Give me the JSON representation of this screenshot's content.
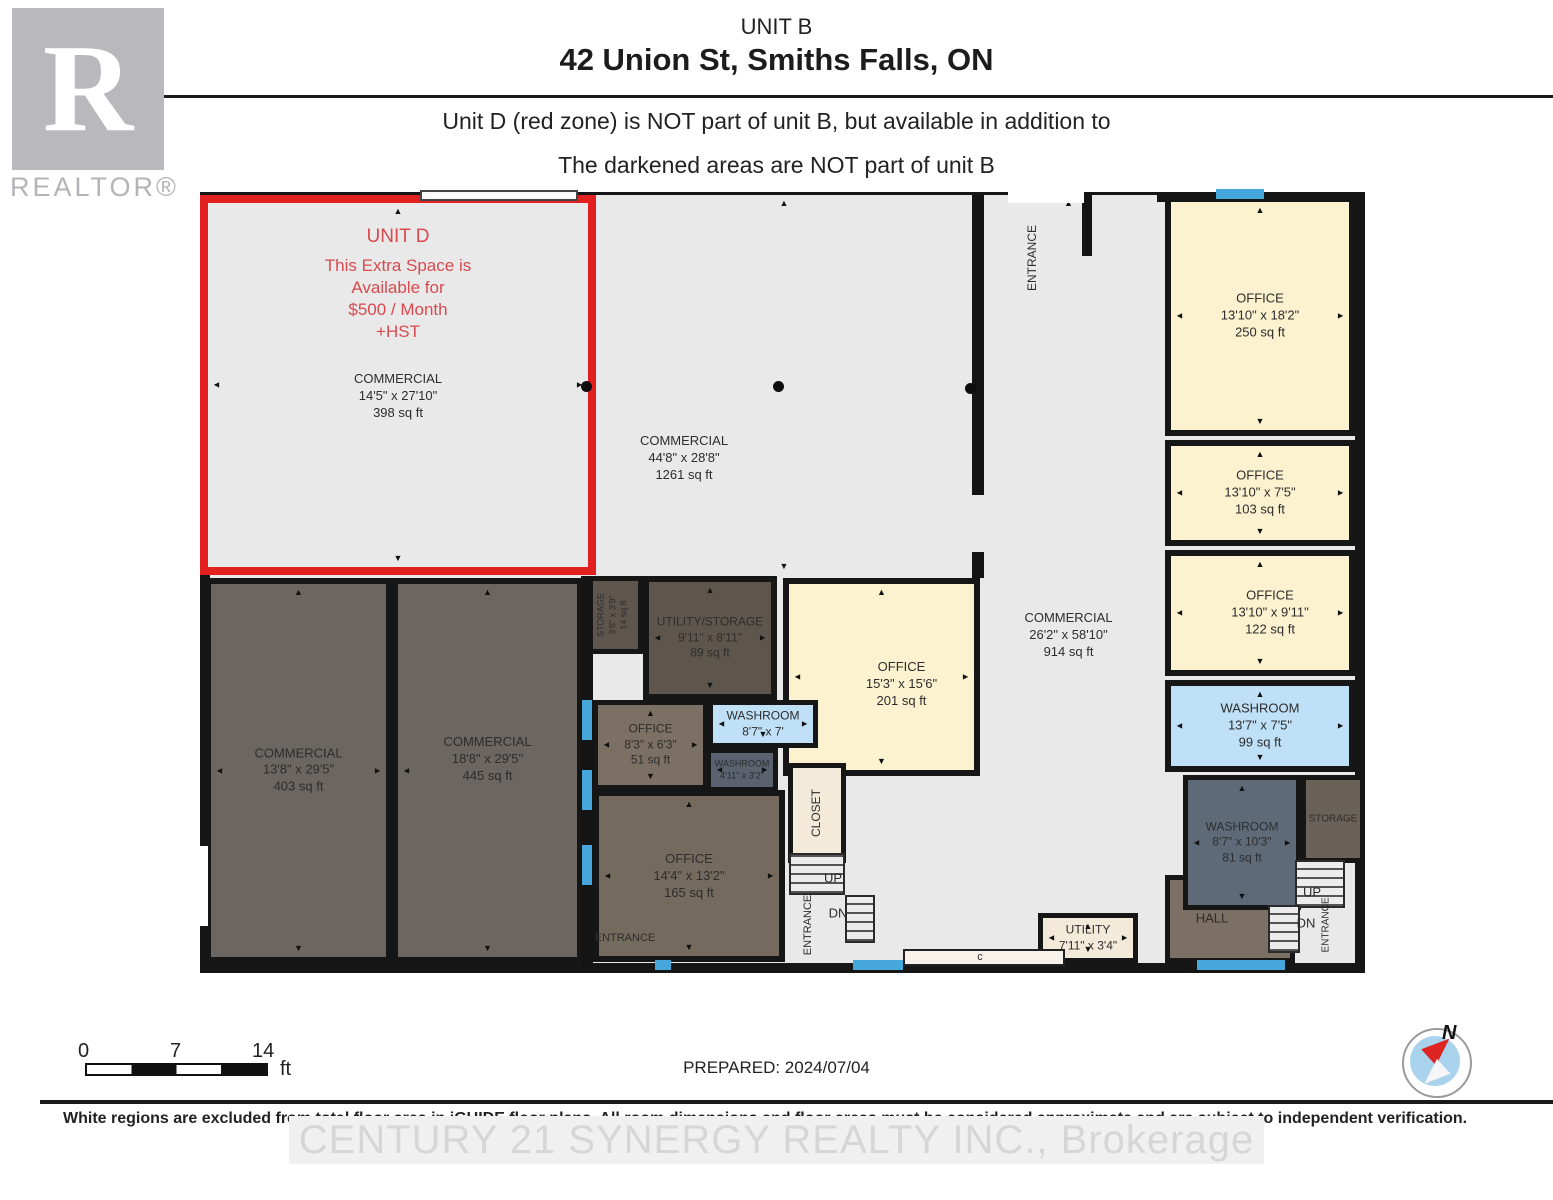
{
  "header": {
    "unit_label": "UNIT B",
    "address": "42 Union St, Smiths Falls, ON",
    "note1": "Unit D (red zone) is NOT part of unit B, but available in addition to",
    "note2": "The darkened areas are NOT part of unit B"
  },
  "logo": {
    "letter": "R",
    "word": "REALTOR®"
  },
  "colors": {
    "unit_d_border": "#e2201f",
    "unit_d_text": "#d84a4e",
    "floor_light": "#e9e9e9",
    "cream": "#fcf2d0",
    "cream_light": "#f3ead9",
    "washroom_blue": "#bfe0f6",
    "window_blue": "#46a7dd",
    "dark_commercial": "#6b6661",
    "dark_utility": "#5e564d",
    "brown_office": "#756a5e",
    "slate_washroom": "#5e6a77",
    "wall": "#141414"
  },
  "floorplan": {
    "rooms": [
      {
        "id": "corridor",
        "x": 980,
        "y": 195,
        "w": 177,
        "h": 768,
        "fill": "#e9e9e9",
        "border": "none",
        "labels": [
          {
            "lines": [
              "COMMERCIAL",
              "26'2\" x 58'10\"",
              "914 sq ft"
            ],
            "size": 13,
            "dy": 415
          }
        ],
        "arrows": [
          "up",
          "down"
        ]
      },
      {
        "id": "commercial-1261",
        "x": 596,
        "y": 195,
        "w": 376,
        "h": 380,
        "fill": "#e9e9e9",
        "border": "none",
        "labels": [
          {
            "lines": [
              "COMMERCIAL",
              "44'8\" x 28'8\"",
              "1261 sq ft"
            ],
            "size": 13,
            "dy": 238,
            "dx": -100
          }
        ],
        "arrows": [
          "up",
          "down"
        ]
      },
      {
        "id": "unit-d",
        "x": 200,
        "y": 195,
        "w": 396,
        "h": 380,
        "fill": "#e9e9e9",
        "border": "8px solid #e2201f",
        "labels": [
          {
            "lines": [
              "UNIT D"
            ],
            "size": 19,
            "dy": 22,
            "color": "#d84a4e"
          },
          {
            "lines": [
              "This Extra Space is",
              "Available for",
              "$500 / Month",
              "+HST"
            ],
            "size": 17,
            "dy": 52,
            "color": "#d84a4e"
          },
          {
            "lines": [
              "COMMERCIAL",
              "14'5\" x 27'10\"",
              "398 sq ft"
            ],
            "size": 13,
            "dy": 168
          }
        ],
        "arrows": [
          "up",
          "down",
          "left",
          "right"
        ]
      },
      {
        "id": "commercial-403",
        "x": 205,
        "y": 578,
        "w": 187,
        "h": 385,
        "fill": "#6b6661",
        "border": "6px solid #161616",
        "labels": [
          {
            "lines": [
              "COMMERCIAL",
              "13'8\" x 29'5\"",
              "403 sq ft"
            ],
            "size": 13
          }
        ],
        "arrows": [
          "up",
          "down",
          "left",
          "right"
        ]
      },
      {
        "id": "commercial-445",
        "x": 392,
        "y": 578,
        "w": 191,
        "h": 385,
        "fill": "#6b6661",
        "border": "6px solid #161616",
        "labels": [
          {
            "lines": [
              "COMMERCIAL",
              "18'8\" x 29'5\"",
              "445 sq ft"
            ],
            "size": 13,
            "dy": 150
          }
        ],
        "arrows": [
          "up",
          "down",
          "left"
        ]
      },
      {
        "id": "office-201",
        "x": 783,
        "y": 578,
        "w": 197,
        "h": 198,
        "fill": "#fcf2d0",
        "border": "6px solid #161616",
        "labels": [
          {
            "lines": [
              "OFFICE",
              "15'3\" x 15'6\"",
              "201 sq ft"
            ],
            "size": 13,
            "dy": 75,
            "dx": 20
          }
        ],
        "arrows": [
          "up",
          "left",
          "right",
          "down"
        ]
      },
      {
        "id": "utility-storage-89",
        "x": 643,
        "y": 576,
        "w": 134,
        "h": 124,
        "fill": "#5e564d",
        "border": "6px solid #161616",
        "labels": [
          {
            "lines": [
              "UTILITY/STORAGE",
              "9'11\" x 8'11\"",
              "89 sq ft"
            ],
            "size": 12
          }
        ],
        "arrows": [
          "up",
          "down",
          "left",
          "right"
        ]
      },
      {
        "id": "storage-14",
        "x": 583,
        "y": 576,
        "w": 60,
        "h": 78,
        "fill": "#5e564d",
        "border": "5px solid #161616",
        "labels": [
          {
            "lines": [
              "STORAGE",
              "3'8\" x 3'9\"",
              "14 sq ft"
            ],
            "size": 9,
            "vertical": true
          }
        ]
      },
      {
        "id": "office-51",
        "x": 593,
        "y": 700,
        "w": 115,
        "h": 90,
        "fill": "#7b7063",
        "border": "5px solid #161616",
        "labels": [
          {
            "lines": [
              "OFFICE",
              "8'3\" x 6'3\"",
              "51 sq ft"
            ],
            "size": 12
          }
        ],
        "arrows": [
          "up",
          "down",
          "left",
          "right"
        ]
      },
      {
        "id": "washroom-8-7",
        "x": 708,
        "y": 700,
        "w": 110,
        "h": 48,
        "fill": "#bfe0f6",
        "border": "5px solid #161616",
        "labels": [
          {
            "lines": [
              "WASHROOM",
              "8'7\" x 7'"
            ],
            "size": 12
          }
        ],
        "arrows": [
          "left",
          "right",
          "down"
        ]
      },
      {
        "id": "washroom-4-11",
        "x": 706,
        "y": 748,
        "w": 72,
        "h": 44,
        "fill": "#59626e",
        "border": "5px solid #161616",
        "labels": [
          {
            "lines": [
              "WASHROOM",
              "4'11\" x 3'2\""
            ],
            "size": 9
          }
        ],
        "arrows": [
          "left",
          "right"
        ]
      },
      {
        "id": "office-165",
        "x": 593,
        "y": 790,
        "w": 192,
        "h": 172,
        "fill": "#746a5e",
        "border": "6px solid #161616",
        "labels": [
          {
            "lines": [
              "OFFICE",
              "14'4\" x 13'2\"",
              "165 sq ft"
            ],
            "size": 13,
            "dy": 55
          }
        ],
        "arrows": [
          "up",
          "down",
          "left",
          "right"
        ]
      },
      {
        "id": "closet",
        "x": 788,
        "y": 763,
        "w": 58,
        "h": 100,
        "fill": "#f3ead9",
        "border": "5px solid #161616",
        "labels": [
          {
            "lines": [
              "CLOSET"
            ],
            "size": 12,
            "vertical": true
          }
        ]
      },
      {
        "id": "office-250",
        "x": 1165,
        "y": 196,
        "w": 190,
        "h": 240,
        "fill": "#fcf2d0",
        "border": "6px solid #161616",
        "labels": [
          {
            "lines": [
              "OFFICE",
              "13'10\" x 18'2\"",
              "250 sq ft"
            ],
            "size": 13
          }
        ],
        "arrows": [
          "up",
          "down",
          "left",
          "right"
        ]
      },
      {
        "id": "office-103",
        "x": 1165,
        "y": 440,
        "w": 190,
        "h": 106,
        "fill": "#fcf2d0",
        "border": "6px solid #161616",
        "labels": [
          {
            "lines": [
              "OFFICE",
              "13'10\" x 7'5\"",
              "103 sq ft"
            ],
            "size": 13
          }
        ],
        "arrows": [
          "up",
          "down",
          "left",
          "right"
        ]
      },
      {
        "id": "office-122",
        "x": 1165,
        "y": 550,
        "w": 190,
        "h": 126,
        "fill": "#fcf2d0",
        "border": "6px solid #161616",
        "labels": [
          {
            "lines": [
              "OFFICE",
              "13'10\" x 9'11\"",
              "122 sq ft"
            ],
            "size": 13,
            "dx": 10
          }
        ],
        "arrows": [
          "up",
          "down",
          "left",
          "right"
        ]
      },
      {
        "id": "washroom-99",
        "x": 1165,
        "y": 680,
        "w": 190,
        "h": 92,
        "fill": "#bfe0f6",
        "border": "6px solid #161616",
        "labels": [
          {
            "lines": [
              "WASHROOM",
              "13'7\" x 7'5\"",
              "99 sq ft"
            ],
            "size": 13
          }
        ],
        "arrows": [
          "up",
          "down",
          "left",
          "right"
        ]
      },
      {
        "id": "hall",
        "x": 1165,
        "y": 875,
        "w": 130,
        "h": 88,
        "fill": "#7c7064",
        "border": "5px solid #161616",
        "labels": [
          {
            "lines": [
              "HALL"
            ],
            "size": 13,
            "dx": -18
          }
        ]
      },
      {
        "id": "washroom-81",
        "x": 1183,
        "y": 775,
        "w": 118,
        "h": 135,
        "fill": "#5e6a77",
        "border": "5px solid #161616",
        "labels": [
          {
            "lines": [
              "WASHROOM",
              "8'7\" x 10'3\"",
              "81 sq ft"
            ],
            "size": 12
          }
        ],
        "arrows": [
          "up",
          "down",
          "left",
          "right"
        ]
      },
      {
        "id": "storage-br",
        "x": 1301,
        "y": 775,
        "w": 64,
        "h": 88,
        "fill": "#6a6158",
        "border": "5px solid #161616",
        "labels": [
          {
            "lines": [
              "STORAGE"
            ],
            "size": 10
          }
        ]
      },
      {
        "id": "utility",
        "x": 1038,
        "y": 913,
        "w": 100,
        "h": 50,
        "fill": "#f3ead9",
        "border": "5px solid #161616",
        "labels": [
          {
            "lines": [
              "UTILITY",
              "7'11\" x 3'4\""
            ],
            "size": 12
          }
        ],
        "arrows": [
          "up",
          "down",
          "left",
          "right"
        ]
      }
    ],
    "features": [
      {
        "type": "rect",
        "name": "wall",
        "x": 972,
        "y": 195,
        "w": 12,
        "h": 300,
        "fill": "#141414"
      },
      {
        "type": "rect",
        "name": "wall",
        "x": 972,
        "y": 552,
        "w": 12,
        "h": 26,
        "fill": "#141414"
      },
      {
        "type": "rect",
        "name": "wall",
        "x": 581,
        "y": 576,
        "w": 12,
        "h": 392,
        "fill": "#141414"
      },
      {
        "type": "rect",
        "name": "wall",
        "x": 1082,
        "y": 192,
        "w": 10,
        "h": 64,
        "fill": "#141414"
      },
      {
        "type": "rect",
        "name": "storefront-window",
        "x": 420,
        "y": 190,
        "w": 158,
        "h": 11,
        "fill": "#fafafa",
        "border": "2px solid #444"
      },
      {
        "type": "rect",
        "name": "entrance-opening",
        "x": 1008,
        "y": 191,
        "w": 76,
        "h": 12,
        "fill": "#ffffff"
      },
      {
        "type": "rect",
        "name": "door-opening",
        "x": 196,
        "y": 846,
        "w": 12,
        "h": 80,
        "fill": "#ffffff"
      },
      {
        "type": "rect",
        "name": "door-recess",
        "x": 903,
        "y": 949,
        "w": 162,
        "h": 17,
        "fill": "#f7f3ea",
        "border": "2px solid #222"
      },
      {
        "type": "rect",
        "name": "window",
        "x": 1216,
        "y": 189,
        "w": 48,
        "h": 10,
        "fill": "#46a7dd"
      },
      {
        "type": "rect",
        "name": "window",
        "x": 853,
        "y": 960,
        "w": 50,
        "h": 10,
        "fill": "#46a7dd"
      },
      {
        "type": "rect",
        "name": "window",
        "x": 1197,
        "y": 960,
        "w": 88,
        "h": 10,
        "fill": "#46a7dd"
      },
      {
        "type": "rect",
        "name": "window",
        "x": 655,
        "y": 960,
        "w": 16,
        "h": 10,
        "fill": "#46a7dd"
      },
      {
        "type": "rect",
        "name": "window",
        "x": 582,
        "y": 700,
        "w": 10,
        "h": 40,
        "fill": "#46a7dd"
      },
      {
        "type": "rect",
        "name": "window",
        "x": 582,
        "y": 770,
        "w": 10,
        "h": 40,
        "fill": "#46a7dd"
      },
      {
        "type": "rect",
        "name": "window",
        "x": 582,
        "y": 845,
        "w": 10,
        "h": 40,
        "fill": "#46a7dd"
      },
      {
        "type": "stairs",
        "name": "stairs-up-mid",
        "x": 789,
        "y": 853,
        "w": 56,
        "h": 42
      },
      {
        "type": "stairs",
        "name": "stairs-dn-mid",
        "x": 845,
        "y": 895,
        "w": 30,
        "h": 48
      },
      {
        "type": "stairs",
        "name": "stairs-up-right",
        "x": 1295,
        "y": 860,
        "w": 50,
        "h": 48
      },
      {
        "type": "stairs",
        "name": "stairs-dn-right",
        "x": 1268,
        "y": 905,
        "w": 32,
        "h": 48
      },
      {
        "type": "dot",
        "name": "column",
        "x": 586,
        "y": 386
      },
      {
        "type": "dot",
        "name": "column",
        "x": 778,
        "y": 386
      },
      {
        "type": "dot",
        "name": "column",
        "x": 970,
        "y": 388
      }
    ],
    "labels": [
      {
        "text": "ENTRANCE",
        "x": 1032,
        "y": 258,
        "vertical": true,
        "size": 12
      },
      {
        "text": "ENTRANCE",
        "x": 625,
        "y": 938,
        "vertical": false,
        "size": 11
      },
      {
        "text": "ENTRANCE",
        "x": 808,
        "y": 925,
        "vertical": true,
        "size": 11
      },
      {
        "text": "ENTRANCE",
        "x": 1326,
        "y": 925,
        "vertical": true,
        "size": 10
      },
      {
        "text": "UP",
        "x": 833,
        "y": 878,
        "vertical": false,
        "size": 13
      },
      {
        "text": "DN",
        "x": 838,
        "y": 913,
        "vertical": false,
        "size": 13
      },
      {
        "text": "UP",
        "x": 1312,
        "y": 892,
        "vertical": false,
        "size": 13
      },
      {
        "text": "DN",
        "x": 1306,
        "y": 923,
        "vertical": false,
        "size": 13
      },
      {
        "text": "c",
        "x": 980,
        "y": 957,
        "vertical": false,
        "size": 11
      }
    ]
  },
  "footer": {
    "scale": {
      "start": "0",
      "mid": "7",
      "end": "14",
      "unit": "ft"
    },
    "prepared": "PREPARED: 2024/07/04",
    "disclaimer": "White regions are excluded from total floor area in iGUIDE floor plans. All room dimensions and floor areas must be considered approximate and are subject to independent verification.",
    "watermark": "CENTURY 21 SYNERGY REALTY INC., Brokerage",
    "compass_label": "N"
  }
}
